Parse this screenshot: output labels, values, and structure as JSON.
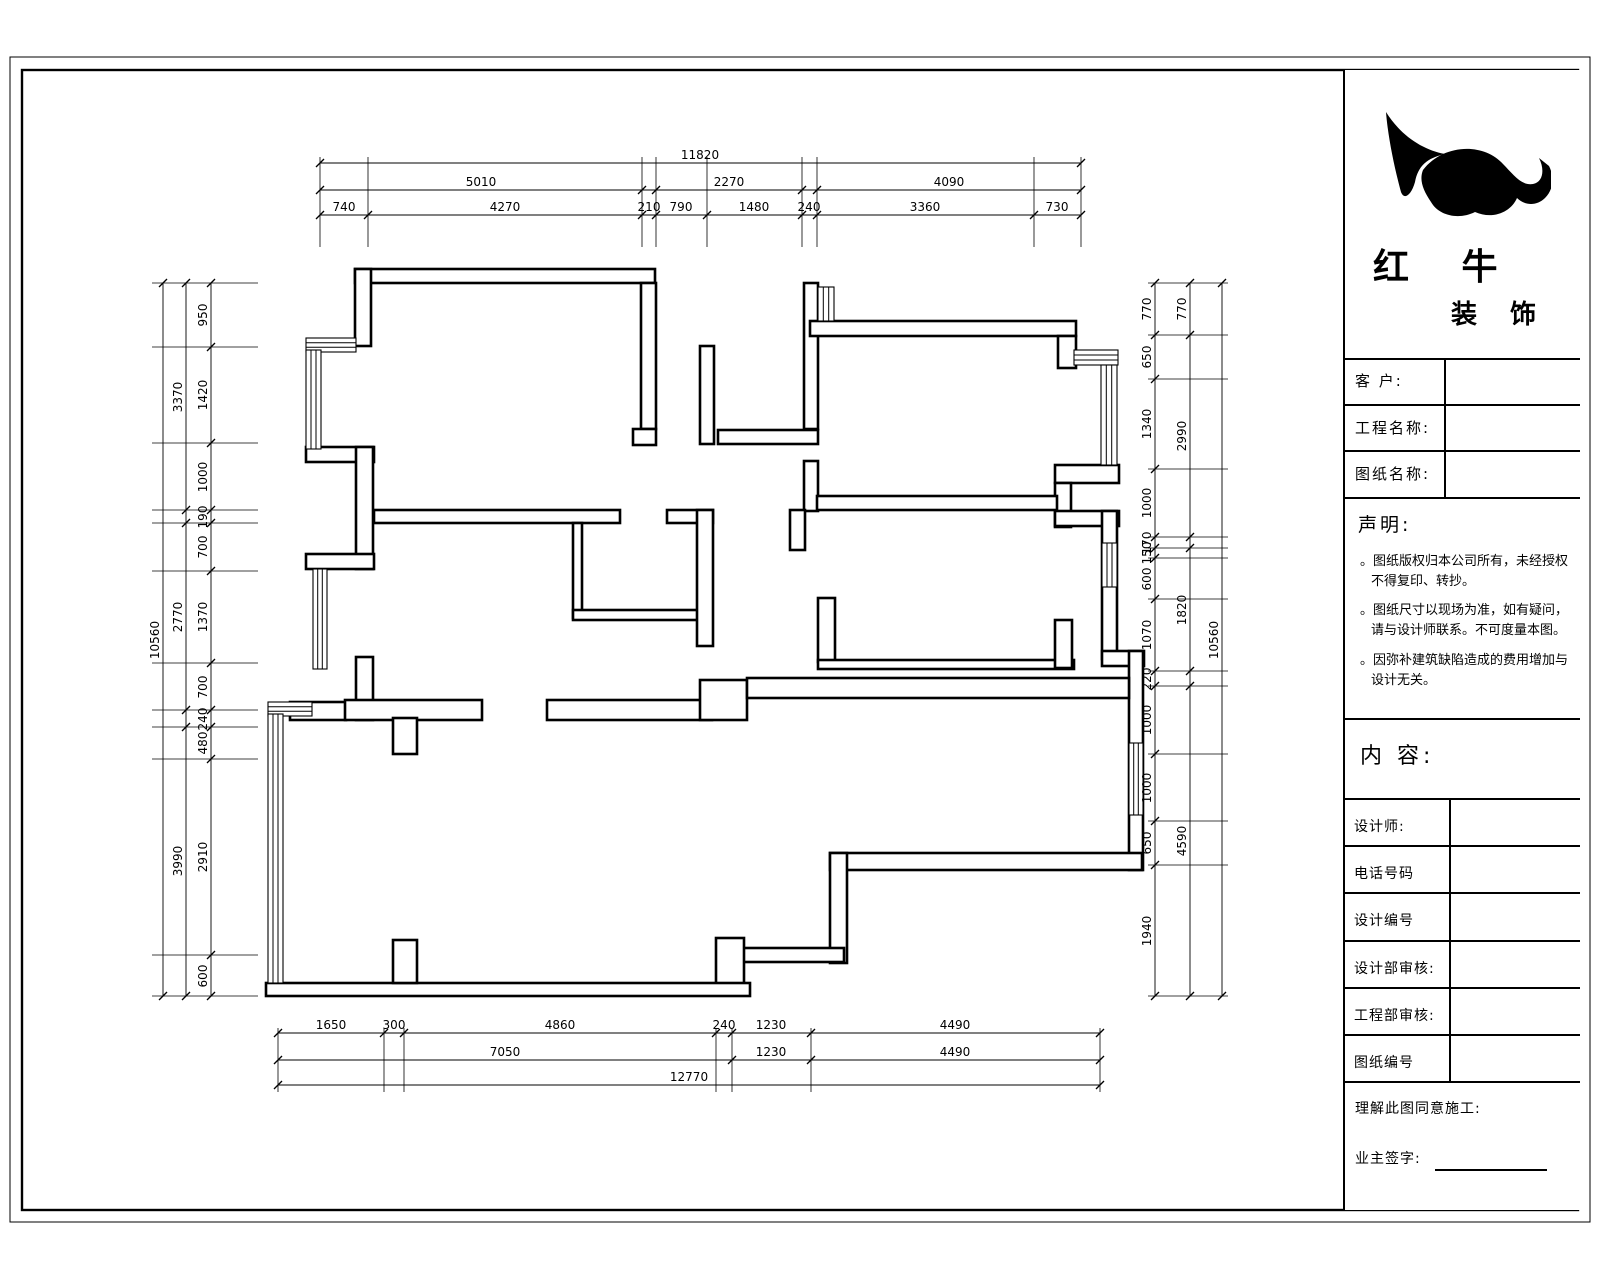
{
  "title_block": {
    "company_name": "红 牛",
    "company_suffix": "装 饰",
    "fields": [
      "客  户:",
      "工程名称:",
      "图纸名称:"
    ],
    "statement": {
      "title": "声明:",
      "items": [
        "。图纸版权归本公司所有，未经授权不得复印、转抄。",
        "。图纸尺寸以现场为准，如有疑问，请与设计师联系。不可度量本图。",
        "。因弥补建筑缺陷造成的费用增加与设计无关。"
      ]
    },
    "content_label": "内 容:",
    "rows": [
      "设计师:",
      "电话号码",
      "设计编号",
      "设计部审核:",
      "工程部审核:",
      "图纸编号"
    ],
    "footer": {
      "line1": "理解此图同意施工:",
      "line2": "业主签字:"
    }
  },
  "floor_plan": {
    "dimensions": {
      "chains": [
        {
          "dir": "h",
          "pos": 163,
          "from": 320,
          "to": 1081,
          "ticks": [
            320,
            1081
          ],
          "labels": [
            {
              "t": "11820",
              "at": 700
            }
          ]
        },
        {
          "dir": "h",
          "pos": 190,
          "from": 320,
          "to": 1081,
          "ticks": [
            320,
            642,
            656,
            802,
            817,
            1081
          ],
          "labels": [
            {
              "t": "5010",
              "at": 481
            },
            {
              "t": "2270",
              "at": 729
            },
            {
              "t": "4090",
              "at": 949
            }
          ]
        },
        {
          "dir": "h",
          "pos": 215,
          "from": 320,
          "to": 1081,
          "ticks": [
            320,
            368,
            642,
            656,
            707,
            802,
            817,
            1034,
            1081
          ],
          "labels": [
            {
              "t": "740",
              "at": 344
            },
            {
              "t": "4270",
              "at": 505
            },
            {
              "t": "210",
              "at": 649
            },
            {
              "t": "790",
              "at": 681
            },
            {
              "t": "1480",
              "at": 754
            },
            {
              "t": "240",
              "at": 809
            },
            {
              "t": "3360",
              "at": 925
            },
            {
              "t": "730",
              "at": 1057
            }
          ]
        },
        {
          "dir": "v",
          "pos": 163,
          "from": 283,
          "to": 996,
          "ticks": [
            283,
            996
          ],
          "labels": [
            {
              "t": "10560",
              "at": 640
            }
          ]
        },
        {
          "dir": "v",
          "pos": 186,
          "from": 283,
          "to": 996,
          "ticks": [
            283,
            510,
            523,
            710,
            727,
            996
          ],
          "labels": [
            {
              "t": "3370",
              "at": 397
            },
            {
              "t": "2770",
              "at": 617
            },
            {
              "t": "3990",
              "at": 861
            }
          ]
        },
        {
          "dir": "v",
          "pos": 211,
          "from": 283,
          "to": 996,
          "ticks": [
            283,
            347,
            443,
            510,
            523,
            571,
            663,
            710,
            727,
            759,
            955,
            996
          ],
          "labels": [
            {
              "t": "950",
              "at": 315
            },
            {
              "t": "1420",
              "at": 395
            },
            {
              "t": "1000",
              "at": 477
            },
            {
              "t": "190",
              "at": 517
            },
            {
              "t": "700",
              "at": 547
            },
            {
              "t": "1370",
              "at": 617
            },
            {
              "t": "700",
              "at": 687
            },
            {
              "t": "240",
              "at": 719
            },
            {
              "t": "480",
              "at": 743
            },
            {
              "t": "2910",
              "at": 857
            },
            {
              "t": "600",
              "at": 976
            }
          ]
        },
        {
          "dir": "v",
          "pos": 1155,
          "from": 283,
          "to": 996,
          "ticks": [
            283,
            335,
            379,
            469,
            537,
            548,
            558,
            599,
            671,
            686,
            754,
            821,
            865,
            996
          ],
          "labels": [
            {
              "t": "770",
              "at": 309
            },
            {
              "t": "650",
              "at": 357
            },
            {
              "t": "1340",
              "at": 424
            },
            {
              "t": "1000",
              "at": 503
            },
            {
              "t": "170",
              "at": 543
            },
            {
              "t": "150",
              "at": 553
            },
            {
              "t": "600",
              "at": 579
            },
            {
              "t": "1070",
              "at": 635
            },
            {
              "t": "220",
              "at": 679
            },
            {
              "t": "1000",
              "at": 720
            },
            {
              "t": "1000",
              "at": 788
            },
            {
              "t": "650",
              "at": 843
            },
            {
              "t": "1940",
              "at": 931
            }
          ]
        },
        {
          "dir": "v",
          "pos": 1190,
          "from": 283,
          "to": 996,
          "ticks": [
            283,
            335,
            537,
            548,
            671,
            686,
            996
          ],
          "labels": [
            {
              "t": "770",
              "at": 309
            },
            {
              "t": "2990",
              "at": 436
            },
            {
              "t": "1820",
              "at": 610
            },
            {
              "t": "4590",
              "at": 841
            }
          ]
        },
        {
          "dir": "v",
          "pos": 1222,
          "from": 283,
          "to": 996,
          "ticks": [
            283,
            996
          ],
          "labels": [
            {
              "t": "10560",
              "at": 640
            }
          ]
        },
        {
          "dir": "h",
          "pos": 1033,
          "from": 278,
          "to": 1100,
          "ticks": [
            278,
            384,
            404,
            716,
            732,
            811,
            1100
          ],
          "labels": [
            {
              "t": "1650",
              "at": 331
            },
            {
              "t": "300",
              "at": 394
            },
            {
              "t": "4860",
              "at": 560
            },
            {
              "t": "240",
              "at": 724
            },
            {
              "t": "1230",
              "at": 771
            },
            {
              "t": "4490",
              "at": 955
            }
          ]
        },
        {
          "dir": "h",
          "pos": 1060,
          "from": 278,
          "to": 1100,
          "ticks": [
            278,
            732,
            811,
            1100
          ],
          "labels": [
            {
              "t": "7050",
              "at": 505
            },
            {
              "t": "1230",
              "at": 771
            },
            {
              "t": "4490",
              "at": 955
            }
          ]
        },
        {
          "dir": "h",
          "pos": 1085,
          "from": 278,
          "to": 1100,
          "ticks": [
            278,
            1100
          ],
          "labels": [
            {
              "t": "12770",
              "at": 689
            }
          ]
        }
      ],
      "extensions": [
        {
          "dir": "v",
          "from": 157,
          "to": 247,
          "at": [
            320,
            368,
            642,
            656,
            707,
            802,
            817,
            1034,
            1081
          ]
        },
        {
          "dir": "v",
          "from": 1028,
          "to": 1092,
          "at": [
            278,
            384,
            404,
            716,
            732,
            811,
            1100
          ]
        },
        {
          "dir": "h",
          "from": 152,
          "to": 258,
          "at": [
            283,
            347,
            443,
            510,
            523,
            571,
            663,
            710,
            727,
            759,
            955,
            996
          ]
        },
        {
          "dir": "h",
          "from": 1148,
          "to": 1228,
          "at": [
            283,
            335,
            379,
            469,
            537,
            548,
            558,
            599,
            671,
            686,
            754,
            821,
            865,
            996
          ]
        }
      ]
    }
  }
}
